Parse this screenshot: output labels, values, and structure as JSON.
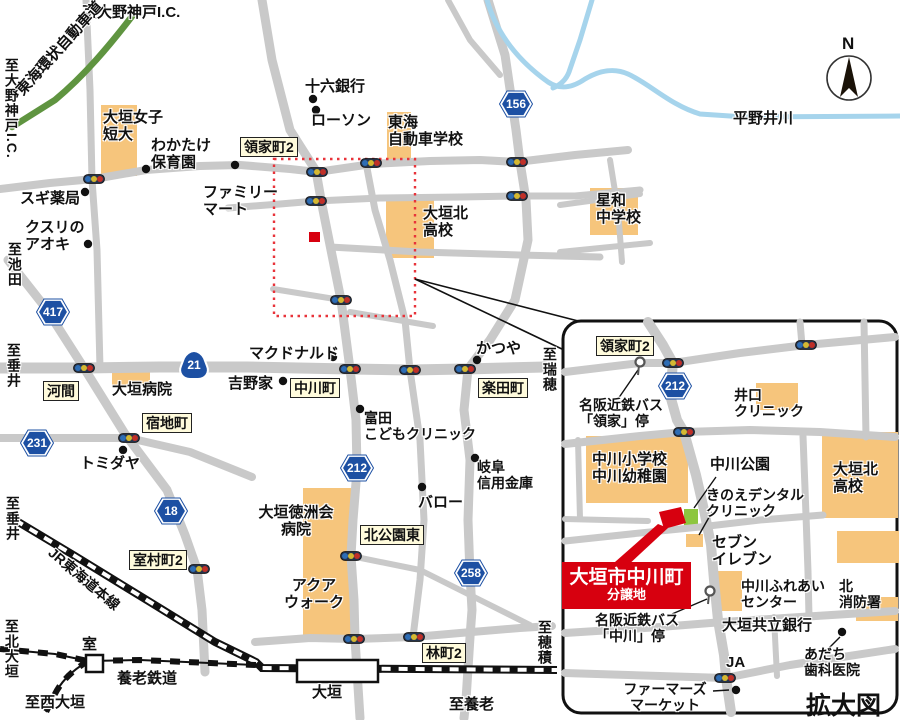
{
  "title": "大垣市中川町 分譲地 案内図",
  "compass": {
    "label": "N"
  },
  "inset": {
    "caption": "拡大図",
    "property": {
      "line1": "大垣市中川町",
      "line2": "分譲地"
    }
  },
  "colors": {
    "road": "#c9c9c9",
    "building": "#f6c57c",
    "park_green": "#8dc63f",
    "river": "#a6d4ec",
    "expressway_green": "#5f9440",
    "shield_blue": "#1d50a3",
    "accent_red": "#d7000f",
    "dotted_red": "#e8333a",
    "label_yellow_bg": "#fffbdc"
  },
  "shields": {
    "hex": [
      {
        "num": "417",
        "x": 53,
        "y": 312
      },
      {
        "num": "231",
        "x": 37,
        "y": 443
      },
      {
        "num": "18",
        "x": 171,
        "y": 511
      },
      {
        "num": "212",
        "x": 357,
        "y": 468
      },
      {
        "num": "156",
        "x": 516,
        "y": 104
      },
      {
        "num": "258",
        "x": 471,
        "y": 573
      },
      {
        "num": "212",
        "x": 675,
        "y": 386
      }
    ],
    "onigiri": [
      {
        "num": "21",
        "x": 194,
        "y": 364
      }
    ]
  },
  "labels": [
    {
      "n": "dest-ono-godo-ic-top",
      "t": "至大野神戸I.C.",
      "x": 82,
      "y": 5,
      "fs": 15
    },
    {
      "n": "dest-ono-godo-ic-left",
      "t": "至大野神戸I.C.",
      "x": 3,
      "y": 58,
      "fs": 14,
      "vert": 1
    },
    {
      "n": "tokai-kanjo-expressway",
      "t": "東海環状自動車道",
      "x": 14,
      "y": 88,
      "fs": 15,
      "rot": -48,
      "w": 175
    },
    {
      "n": "juroku-bank",
      "t": "十六銀行",
      "x": 305,
      "y": 79,
      "fs": 15
    },
    {
      "n": "lawson",
      "t": "ローソン",
      "x": 311,
      "y": 113,
      "fs": 15
    },
    {
      "n": "tokai-driving-school",
      "t": "東海\n自動車学校",
      "x": 388,
      "y": 115,
      "fs": 15
    },
    {
      "n": "ogaki-womens-college",
      "t": "大垣女子\n短大",
      "x": 103,
      "y": 110,
      "fs": 15
    },
    {
      "n": "wakatake-nursery",
      "t": "わかたけ\n保育園",
      "x": 151,
      "y": 138,
      "fs": 15
    },
    {
      "n": "sugi-pharmacy",
      "t": "スギ薬局",
      "x": 20,
      "y": 191,
      "fs": 15
    },
    {
      "n": "kusuri-no-aoki",
      "t": "クスリの\nアオキ",
      "x": 25,
      "y": 220,
      "fs": 15
    },
    {
      "n": "family-mart",
      "t": "ファミリー\nマート",
      "x": 203,
      "y": 185,
      "fs": 15
    },
    {
      "n": "ryokecho2",
      "t": "領家町2",
      "x": 240,
      "y": 137,
      "fs": 14,
      "type": "yellow"
    },
    {
      "n": "ogaki-kita-hs",
      "t": "大垣北\n高校",
      "x": 423,
      "y": 206,
      "fs": 15
    },
    {
      "n": "seiwa-jhs",
      "t": "星和\n中学校",
      "x": 596,
      "y": 193,
      "fs": 15
    },
    {
      "n": "hiranoi-river",
      "t": "平野井川",
      "x": 733,
      "y": 111,
      "fs": 15
    },
    {
      "n": "dest-ikeda",
      "t": "至池田",
      "x": 6,
      "y": 242,
      "fs": 14,
      "vert": 1
    },
    {
      "n": "dest-tarui",
      "t": "至垂井",
      "x": 5,
      "y": 343,
      "fs": 14,
      "vert": 1
    },
    {
      "n": "kama",
      "t": "河間",
      "x": 43,
      "y": 381,
      "fs": 14,
      "type": "yellow"
    },
    {
      "n": "ogaki-hospital",
      "t": "大垣病院",
      "x": 112,
      "y": 382,
      "fs": 15
    },
    {
      "n": "mcdonalds",
      "t": "マクドナルド",
      "x": 249,
      "y": 346,
      "fs": 15
    },
    {
      "n": "yoshinoya",
      "t": "吉野家",
      "x": 228,
      "y": 376,
      "fs": 15
    },
    {
      "n": "nakagawacho",
      "t": "中川町",
      "x": 290,
      "y": 378,
      "fs": 14,
      "type": "yellow"
    },
    {
      "n": "gakudencho",
      "t": "楽田町",
      "x": 478,
      "y": 378,
      "fs": 14,
      "type": "yellow"
    },
    {
      "n": "katsuya",
      "t": "かつや",
      "x": 476,
      "y": 341,
      "fs": 15
    },
    {
      "n": "dest-mizuho",
      "t": "至瑞穂",
      "x": 541,
      "y": 347,
      "fs": 14,
      "vert": 1
    },
    {
      "n": "shukuchicho",
      "t": "宿地町",
      "x": 142,
      "y": 413,
      "fs": 14,
      "type": "yellow"
    },
    {
      "n": "tomita-kids-clinic",
      "t": "富田\nこどもクリニック",
      "x": 364,
      "y": 411,
      "fs": 14
    },
    {
      "n": "tomidaya",
      "t": "トミダヤ",
      "x": 80,
      "y": 456,
      "fs": 15
    },
    {
      "n": "gifu-shinkin-bank",
      "t": "岐阜\n信用金庫",
      "x": 477,
      "y": 460,
      "fs": 14
    },
    {
      "n": "valor",
      "t": "バロー",
      "x": 418,
      "y": 495,
      "fs": 15
    },
    {
      "n": "tokushukai-hospital",
      "t": "大垣徳洲会\n病院",
      "x": 248,
      "y": 505,
      "fs": 15,
      "w": 96,
      "align": "center"
    },
    {
      "n": "aqua-walk",
      "t": "アクア\nウォーク",
      "x": 283,
      "y": 578,
      "fs": 15,
      "w": 62,
      "align": "center"
    },
    {
      "n": "kita-koen-higashi",
      "t": "北公園東",
      "x": 360,
      "y": 525,
      "fs": 14,
      "type": "yellow"
    },
    {
      "n": "muromuracho2",
      "t": "室村町2",
      "x": 129,
      "y": 550,
      "fs": 14,
      "type": "yellow"
    },
    {
      "n": "hayashicho2",
      "t": "林町2",
      "x": 422,
      "y": 643,
      "fs": 14,
      "type": "yellow"
    },
    {
      "n": "dest-tarui-south",
      "t": "至垂井",
      "x": 4,
      "y": 496,
      "fs": 14,
      "vert": 1
    },
    {
      "n": "dest-kita-ogaki",
      "t": "至北大垣",
      "x": 3,
      "y": 619,
      "fs": 14,
      "vert": 1
    },
    {
      "n": "dest-nishi-ogaki",
      "t": "至西大垣",
      "x": 25,
      "y": 695,
      "fs": 15
    },
    {
      "n": "muro-station-label",
      "t": "室",
      "x": 82,
      "y": 637,
      "fs": 15
    },
    {
      "n": "ogaki-station-label",
      "t": "大垣",
      "x": 312,
      "y": 685,
      "fs": 15
    },
    {
      "n": "yoro-railway-label",
      "t": "養老鉄道",
      "x": 117,
      "y": 671,
      "fs": 15
    },
    {
      "n": "jr-tokaido-line-label",
      "t": "JR東海道本線",
      "x": 55,
      "y": 545,
      "fs": 14,
      "rot": 40,
      "w": 135
    },
    {
      "n": "dest-yoro",
      "t": "至養老",
      "x": 449,
      "y": 697,
      "fs": 15
    },
    {
      "n": "dest-hozumi",
      "t": "至穂積",
      "x": 536,
      "y": 620,
      "fs": 14,
      "vert": 1
    },
    {
      "n": "inset-ryokecho2",
      "t": "領家町2",
      "x": 596,
      "y": 336,
      "fs": 14,
      "type": "yellow"
    },
    {
      "n": "bus-ryoke-stop",
      "t": "名阪近鉄バス\n「領家」停",
      "x": 579,
      "y": 398,
      "fs": 14
    },
    {
      "n": "iguchi-clinic",
      "t": "井口\nクリニック",
      "x": 734,
      "y": 388,
      "fs": 14
    },
    {
      "n": "nakagawa-elementary-kindergarten",
      "t": "中川小学校\n中川幼稚園",
      "x": 592,
      "y": 452,
      "fs": 15
    },
    {
      "n": "nakagawa-park",
      "t": "中川公園",
      "x": 710,
      "y": 457,
      "fs": 15
    },
    {
      "n": "kinoe-dental-clinic",
      "t": "きのえデンタル\nクリニック",
      "x": 706,
      "y": 488,
      "fs": 14
    },
    {
      "n": "seven-eleven",
      "t": "セブン\nイレブン",
      "x": 712,
      "y": 535,
      "fs": 15
    },
    {
      "n": "bus-nakagawa-stop",
      "t": "名阪近鉄バス\n「中川」停",
      "x": 595,
      "y": 613,
      "fs": 14
    },
    {
      "n": "nakagawa-fureai-center",
      "t": "中川ふれあい\nセンター",
      "x": 741,
      "y": 579,
      "fs": 14
    },
    {
      "n": "kita-fire-station",
      "t": "北\n消防署",
      "x": 839,
      "y": 579,
      "fs": 14
    },
    {
      "n": "ogaki-kyoritsu-bank",
      "t": "大垣共立銀行",
      "x": 722,
      "y": 618,
      "fs": 15
    },
    {
      "n": "adachi-dental",
      "t": "あだち\n歯科医院",
      "x": 804,
      "y": 647,
      "fs": 14
    },
    {
      "n": "ja",
      "t": "JA",
      "x": 726,
      "y": 655,
      "fs": 15
    },
    {
      "n": "farmers-market",
      "t": "ファーマーズ\nマーケット",
      "x": 616,
      "y": 682,
      "fs": 14,
      "w": 98,
      "align": "center"
    },
    {
      "n": "inset-ogaki-kita-hs",
      "t": "大垣北\n高校",
      "x": 833,
      "y": 462,
      "fs": 15
    }
  ],
  "features": {
    "signals": [
      [
        94,
        179
      ],
      [
        317,
        172
      ],
      [
        371,
        163
      ],
      [
        316,
        201
      ],
      [
        517,
        162
      ],
      [
        517,
        196
      ],
      [
        341,
        300
      ],
      [
        84,
        368
      ],
      [
        350,
        369
      ],
      [
        410,
        370
      ],
      [
        465,
        369
      ],
      [
        129,
        438
      ],
      [
        199,
        569
      ],
      [
        351,
        556
      ],
      [
        354,
        639
      ],
      [
        414,
        637
      ],
      [
        673,
        363
      ],
      [
        806,
        345
      ],
      [
        684,
        432
      ],
      [
        725,
        678
      ]
    ],
    "dots": [
      [
        313,
        99
      ],
      [
        316,
        110
      ],
      [
        146,
        169
      ],
      [
        235,
        165
      ],
      [
        85,
        192
      ],
      [
        88,
        244
      ],
      [
        333,
        357
      ],
      [
        283,
        381
      ],
      [
        477,
        360
      ],
      [
        360,
        409
      ],
      [
        123,
        450
      ],
      [
        422,
        487
      ],
      [
        475,
        458
      ],
      [
        842,
        632
      ],
      [
        736,
        690
      ]
    ],
    "bus_stops": [
      [
        640,
        362
      ],
      [
        710,
        591
      ]
    ],
    "blocks": [
      [
        101,
        105,
        36,
        71
      ],
      [
        387,
        112,
        24,
        47
      ],
      [
        386,
        200,
        48,
        58
      ],
      [
        590,
        188,
        48,
        47
      ],
      [
        112,
        372,
        38,
        13
      ],
      [
        303,
        488,
        48,
        150
      ],
      [
        756,
        383,
        42,
        27
      ],
      [
        586,
        436,
        102,
        67
      ],
      [
        822,
        432,
        76,
        86
      ],
      [
        837,
        531,
        62,
        32
      ],
      [
        714,
        571,
        28,
        40
      ],
      [
        856,
        597,
        42,
        24
      ],
      [
        686,
        534,
        17,
        13
      ]
    ],
    "green_blocks": [
      [
        684,
        509,
        14,
        19
      ]
    ],
    "stations": [
      [
        297,
        660,
        81,
        22
      ],
      [
        86,
        655,
        17,
        17
      ]
    ],
    "leader_lines": [
      [
        415,
        279,
        586,
        323
      ],
      [
        415,
        279,
        564,
        350
      ],
      [
        638,
        370,
        618,
        399
      ],
      [
        707,
        599,
        672,
        614
      ],
      [
        716,
        477,
        694,
        508
      ],
      [
        712,
        512,
        699,
        535
      ],
      [
        840,
        637,
        827,
        650
      ],
      [
        713,
        691,
        729,
        690
      ]
    ]
  },
  "geometry": {
    "roads_main": [
      {
        "d": "M0,189 L50,183 L94,179 L146,170 L200,166 L240,165 L290,169 L317,172 L372,164 L430,161 L480,160 L517,162 L575,155 L628,150",
        "w": 8
      },
      {
        "d": "M228,208 L280,204 L316,201 L380,198 L460,197 L517,196 L575,196 L640,190",
        "w": 7
      },
      {
        "d": "M0,368 L84,368 L160,367 L247,367 L350,369 L410,370 L465,369 L545,367",
        "w": 11
      },
      {
        "d": "M8,260 L45,307 L84,368 L125,434 L167,490 L185,535 L197,569 L202,610 L205,672",
        "w": 9
      },
      {
        "d": "M86,0 L90,90 L92,180 L97,250 L100,368",
        "w": 7
      },
      {
        "d": "M0,438 L129,438 L190,452 L252,477",
        "w": 8
      },
      {
        "d": "M262,0 L272,60 L290,130 L316,171 L322,205 L333,260 L341,300 L350,369 L356,420 L357,470 L353,520 L351,556 L354,600 L355,639 L360,718",
        "w": 9
      },
      {
        "d": "M366,163 L375,210 L390,260 L405,320 L410,370 L420,440 L424,520 L420,580 L413,637",
        "w": 7
      },
      {
        "d": "M488,0 L505,55 L516,130 L520,162 L526,200 L528,240 L515,300 L490,340 L468,369 L464,410 L470,460 L468,520 L470,574 L472,610 L470,637 L466,700 L464,718",
        "w": 9
      },
      {
        "d": "M255,642 L310,638 L354,639 L414,637 L460,633 L520,628 L552,626",
        "w": 8
      },
      {
        "d": "M351,556 L420,570 L480,600 L530,625",
        "w": 6
      },
      {
        "d": "M273,289 L341,300",
        "w": 6
      },
      {
        "d": "M350,312 L433,326",
        "w": 6
      },
      {
        "d": "M330,247 L420,252 L520,255 L600,257",
        "w": 7
      },
      {
        "d": "M560,205 L640,194",
        "w": 6
      },
      {
        "d": "M610,160 L618,210 L622,262",
        "w": 6
      },
      {
        "d": "M560,252 L650,243",
        "w": 6
      },
      {
        "d": "M448,0 L470,40 L500,75",
        "w": 6
      }
    ],
    "roads_inset": [
      {
        "d": "M648,322 L663,345 L673,363 L670,395 L677,420 L684,432 L696,475 L704,510 L711,545 L714,580 L718,620 L724,655 L726,678 L731,712",
        "w": 10
      },
      {
        "d": "M565,372 L640,363 L673,363 L740,353 L806,345 L895,337",
        "w": 8
      },
      {
        "d": "M565,444 L640,436 L684,432 L750,430 L820,432 L895,437",
        "w": 8
      },
      {
        "d": "M565,541 L640,533 L700,527 L760,520 L823,515",
        "w": 7
      },
      {
        "d": "M565,633 L660,627 L723,622 L800,617 L895,611",
        "w": 8
      },
      {
        "d": "M565,673 L660,676 L725,678 L790,665 L895,649",
        "w": 8
      },
      {
        "d": "M800,322 L802,345",
        "w": 7
      },
      {
        "d": "M864,322 L866,437",
        "w": 7
      },
      {
        "d": "M803,436 L806,515 L808,572 L809,617",
        "w": 7
      },
      {
        "d": "M578,440 L580,519",
        "w": 6
      },
      {
        "d": "M565,519 L648,521",
        "w": 6
      },
      {
        "d": "M774,617 L777,676",
        "w": 6
      }
    ],
    "rivers": [
      "M487,0 C497,35 520,62 548,82 C560,90 572,88 585,79 C600,70 615,68 628,74 C650,84 670,105 700,114 L745,117 L900,116",
      "M592,0 L580,40 L569,72 C566,80 560,85 553,88"
    ],
    "expressway": "M133,15 C110,45 85,75 55,100 L12,127",
    "jr_line": "M15,520 L75,556 L150,602 L215,642 L256,662 L262,668 L557,670",
    "yoro_lines": [
      "M0,649 L55,654 L88,661 L140,660 L256,665",
      "M88,661 C70,672 60,683 54,696 L46,712"
    ],
    "dotted_rect": [
      274,
      159,
      141,
      157
    ],
    "inset_box": [
      563,
      321,
      334,
      392,
      18
    ],
    "red_wedge": "658,524 668,528 626,567 615,562",
    "red_quad": "659,512 681,507 686,523 664,529",
    "red_square": [
      309,
      232,
      11,
      10
    ],
    "compass": {
      "cx": 849,
      "cy": 78,
      "r": 22,
      "arrow": "849,57 858,97 849,88 840,97"
    }
  }
}
